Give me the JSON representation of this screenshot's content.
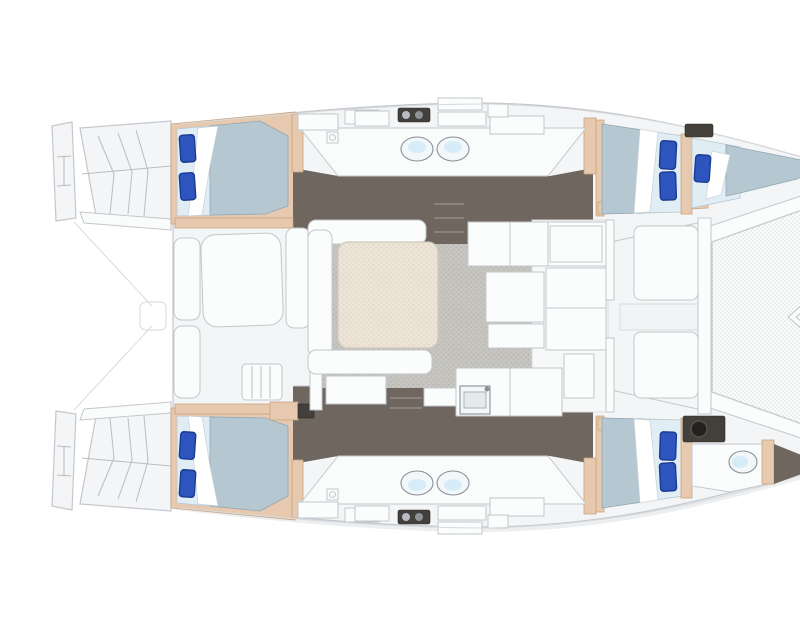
{
  "title": "Catamaran yacht floor plan - top view, bow to the right",
  "type": "boat-deck-layout-illustration",
  "palette": {
    "deck": "#f4f5f6",
    "deck2": "#fafbfb",
    "edge": "#c3c7cc",
    "counter": "#fbfcfc",
    "tan": "#e6c9ae",
    "tanline": "#c9a37e",
    "floor": "#6e665f",
    "unit": "#433f3b",
    "bedbase": "#e1edf4",
    "duvet": "#b5c8d2",
    "pillow": "#2d55bd",
    "pillowdk": "#1b3a92",
    "fixture": "#f2f7f9",
    "fixline": "#8a9096",
    "shadow": "#eceef0",
    "meshbg": "#fcfdfd",
    "meshdot": "#d5d8db",
    "carpet": "#c7c5c0",
    "carpetdot": "#b4b2ad",
    "table": "#ece4d6",
    "tabledot": "#ded4c2"
  },
  "inventory": {
    "double_cabins": 4,
    "forepeak_berth": 1,
    "blue_pillows": 9,
    "oval_basins": 4,
    "bow_toilet": 1,
    "bow_sink": 1,
    "saloon_table": 1,
    "aft_cockpit_table": 1,
    "forward_cockpit_benches": 2,
    "trampoline": 1,
    "stern_platforms": 2
  },
  "areas": [
    {
      "name": "stern-platform-port",
      "role": "swim platform and transom steps"
    },
    {
      "name": "stern-platform-starboard",
      "role": "swim platform and transom steps"
    },
    {
      "name": "aft-cockpit",
      "role": "cockpit with table and benches"
    },
    {
      "name": "cabin-aft-port",
      "role": "double cabin"
    },
    {
      "name": "cabin-aft-starboard",
      "role": "double cabin"
    },
    {
      "name": "head-port",
      "role": "bathroom with twin basins"
    },
    {
      "name": "head-starboard",
      "role": "bathroom with twin basins"
    },
    {
      "name": "saloon",
      "role": "dinette with table on carpet"
    },
    {
      "name": "galley",
      "role": "L-shaped galley with sink"
    },
    {
      "name": "cabin-fwd-port",
      "role": "double cabin"
    },
    {
      "name": "cabin-fwd-starboard",
      "role": "double cabin"
    },
    {
      "name": "forepeak-berth-port",
      "role": "single bow berth"
    },
    {
      "name": "bow-head-starboard",
      "role": "WC with toilet and sink"
    },
    {
      "name": "forward-cockpit",
      "role": "lounge benches"
    },
    {
      "name": "trampoline",
      "role": "bow netting"
    }
  ]
}
